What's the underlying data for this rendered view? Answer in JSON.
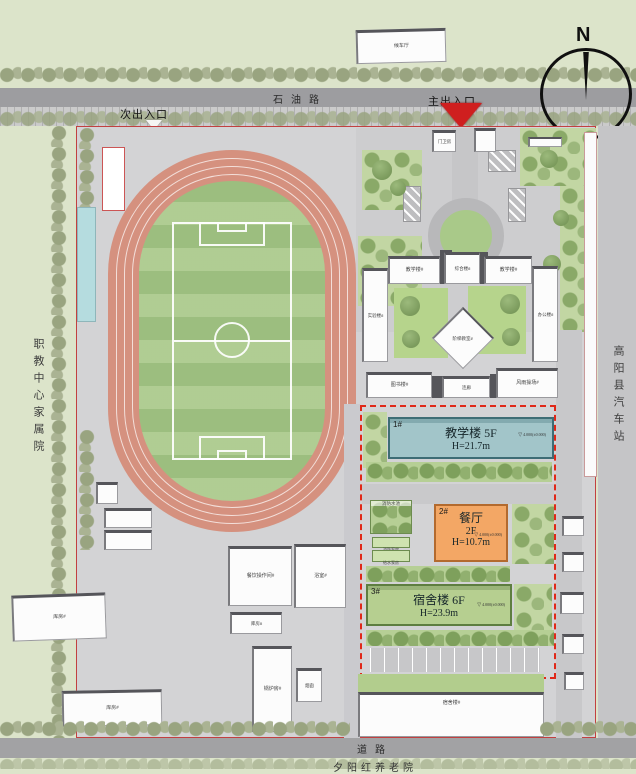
{
  "compass": {
    "label": "N"
  },
  "roads": {
    "top": "石油路",
    "bottom": "道路"
  },
  "entrances": {
    "secondary": "次出入口",
    "main": "主出入口"
  },
  "surroundings": {
    "west": "职教中心家属院",
    "east": "高阳县汽车站",
    "south": "夕阳红养老院",
    "bus_hall": "候车厅"
  },
  "new_buildings": {
    "b1": {
      "tag": "1#",
      "name": "教学楼 5F",
      "height": "H=21.7m",
      "elev": "4.000(±0.000)"
    },
    "b2": {
      "tag": "2#",
      "name": "餐厅",
      "floors": "2F",
      "height": "H=10.7m",
      "elev": "4.000(±0.000)"
    },
    "b3": {
      "tag": "3#",
      "name": "宿舍楼 6F",
      "height": "H=23.9m",
      "elev": "4.000(±0.000)"
    }
  },
  "existing": {
    "gate": "门卫房",
    "teach_w": "教学楼#",
    "comprehensive": "综合楼#",
    "teach_e": "教学楼#",
    "lab": "实验楼#",
    "office": "办公楼#",
    "lecture": "阶梯教室#",
    "library": "图书楼#",
    "corridor": "连廊",
    "gym": "风雨操场#",
    "dorm_s": "宿舍楼#",
    "kitchen": "餐饮操作间#",
    "bath": "浴室#",
    "boiler": "锅炉房#",
    "chimney": "烟囱",
    "store1": "库房#",
    "store2": "库房#",
    "store3": "库房#"
  },
  "utilities": {
    "pool": "消防水池",
    "fire_pump": "消防泵房",
    "water_pump": "给水泵房"
  },
  "colors": {
    "track": "#d5917f",
    "field": "#a7c787",
    "building1": "#a2c5c9",
    "building2": "#f3a765",
    "building3": "#b6cf90",
    "boundary_dashed": "#e02818",
    "entrance_arrow": "#cf1f1f",
    "site_line": "#c24040"
  }
}
